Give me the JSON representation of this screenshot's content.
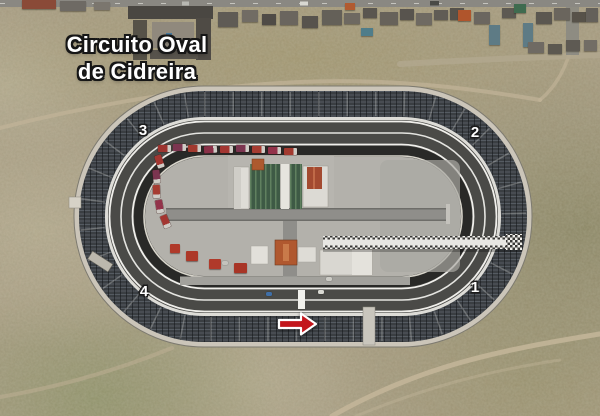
{
  "title": {
    "line1": "Circuito Oval",
    "line2": "de Cidreira"
  },
  "corner_labels": [
    {
      "name": "turn-1",
      "label": "1"
    },
    {
      "name": "turn-2",
      "label": "2"
    },
    {
      "name": "turn-3",
      "label": "3"
    },
    {
      "name": "turn-4",
      "label": "4"
    }
  ],
  "direction_arrow": {
    "meaning": "race-direction",
    "color": "#c3161c",
    "outline": "#ffffff"
  },
  "colors": {
    "track_asphalt": "#4a4a47",
    "inner_apron": "#292927",
    "infield_concrete": "#b3b1ab",
    "grandstand": "#3a3e42",
    "outer_walkway": "#cbc5b9",
    "terrain": "#a89a81",
    "title_text": "#ffffff",
    "title_outline": "#161616"
  },
  "scenery": {
    "houses": [
      [
        22,
        0,
        34,
        9,
        "#8a4a38"
      ],
      [
        60,
        1,
        26,
        10,
        "#6e6a64"
      ],
      [
        94,
        2,
        16,
        8,
        "#7b766e"
      ],
      [
        218,
        12,
        20,
        15,
        "#5f5b55"
      ],
      [
        242,
        10,
        16,
        12,
        "#716c64"
      ],
      [
        262,
        14,
        14,
        11,
        "#4f4b46"
      ],
      [
        280,
        11,
        18,
        14,
        "#6a655e"
      ],
      [
        302,
        16,
        16,
        12,
        "#57534d"
      ],
      [
        322,
        10,
        20,
        15,
        "#646058"
      ],
      [
        345,
        3,
        10,
        7,
        "#b15a30"
      ],
      [
        344,
        13,
        16,
        11,
        "#6e6961"
      ],
      [
        363,
        8,
        14,
        10,
        "#5a564f"
      ],
      [
        361,
        28,
        12,
        8,
        "#4f7d8a"
      ],
      [
        380,
        12,
        18,
        13,
        "#67625a"
      ],
      [
        400,
        9,
        14,
        11,
        "#58544e"
      ],
      [
        416,
        13,
        16,
        12,
        "#6f6a62"
      ],
      [
        434,
        10,
        14,
        10,
        "#605c55"
      ],
      [
        450,
        8,
        14,
        12,
        "#56524b"
      ],
      [
        458,
        10,
        13,
        11,
        "#b0552c"
      ],
      [
        474,
        12,
        16,
        12,
        "#6b665f"
      ],
      [
        489,
        25,
        11,
        20,
        "#5e7b85"
      ],
      [
        502,
        8,
        14,
        10,
        "#5d5952"
      ],
      [
        514,
        4,
        12,
        9,
        "#3f6b4f"
      ],
      [
        523,
        23,
        10,
        24,
        "#5e7b85"
      ],
      [
        536,
        12,
        16,
        12,
        "#5b5750"
      ],
      [
        554,
        8,
        16,
        12,
        "#6a655d"
      ],
      [
        572,
        12,
        14,
        10,
        "#575249"
      ],
      [
        586,
        8,
        12,
        14,
        "#64605a"
      ],
      [
        528,
        42,
        16,
        11,
        "#6f6a63"
      ],
      [
        548,
        44,
        14,
        10,
        "#5c5850"
      ],
      [
        566,
        40,
        14,
        11,
        "#5e5a53"
      ],
      [
        584,
        40,
        13,
        11,
        "#726d65"
      ]
    ],
    "trucks": [
      [
        158,
        145,
        0,
        "#9d3530"
      ],
      [
        173,
        144,
        0,
        "#7c3550"
      ],
      [
        188,
        145,
        0,
        "#a23a2f"
      ],
      [
        204,
        146,
        -4,
        "#8a3148"
      ],
      [
        220,
        146,
        0,
        "#a33631"
      ],
      [
        236,
        145,
        0,
        "#7c3550"
      ],
      [
        252,
        146,
        0,
        "#a63c31"
      ],
      [
        268,
        147,
        0,
        "#93334a"
      ],
      [
        284,
        148,
        0,
        "#a23a2f"
      ],
      [
        153,
        158,
        72,
        "#a33631"
      ],
      [
        150,
        173,
        84,
        "#7c3550"
      ],
      [
        150,
        188,
        88,
        "#a63c31"
      ],
      [
        153,
        203,
        80,
        "#93334a"
      ],
      [
        159,
        218,
        68,
        "#a33631"
      ]
    ],
    "kiosks": [
      [
        170,
        244,
        10,
        9,
        "#b03a2a"
      ],
      [
        186,
        251,
        12,
        10,
        "#ad3828"
      ],
      [
        209,
        259,
        12,
        10,
        "#b03a2a"
      ],
      [
        234,
        263,
        13,
        10,
        "#a83526"
      ]
    ],
    "cars": [
      [
        266,
        292,
        "#3f6fa8"
      ],
      [
        318,
        290,
        "#d9d9d3"
      ],
      [
        326,
        277,
        "#cccbc5"
      ],
      [
        222,
        261,
        "#c4c3bd"
      ]
    ]
  }
}
